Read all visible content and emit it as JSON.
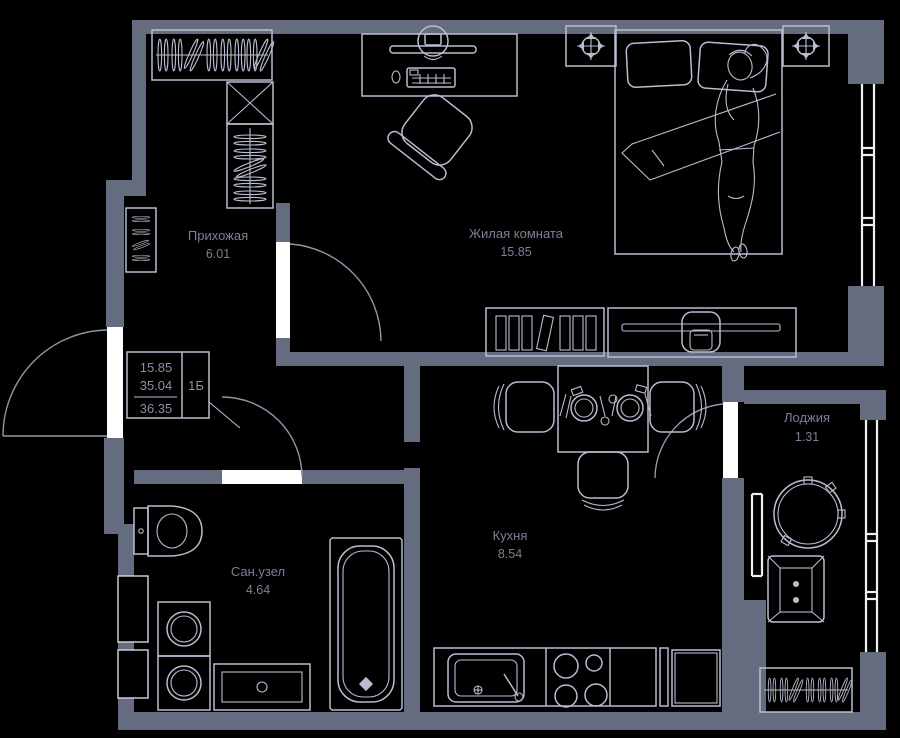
{
  "plan": {
    "title": "apartment-floor-plan",
    "legend": {
      "living_area": "15.85",
      "area_without_loggia": "35.04",
      "total_area": "36.35",
      "apartment_type": "1Б"
    },
    "rooms": [
      {
        "id": "hallway",
        "name": "Прихожая",
        "area": "6.01"
      },
      {
        "id": "living",
        "name": "Жилая комната",
        "area": "15.85"
      },
      {
        "id": "kitchen",
        "name": "Кухня",
        "area": "8.54"
      },
      {
        "id": "bathroom",
        "name": "Сан.узел",
        "area": "4.64"
      },
      {
        "id": "loggia",
        "name": "Лоджия",
        "area": "1.31"
      }
    ],
    "colors": {
      "background": "#000000",
      "wall": "#666c80",
      "furniture_line": "#b9bdcf",
      "door_leaf": "#ffffff",
      "window_line": "#eef0f6",
      "label_text": "#7b8196"
    }
  }
}
